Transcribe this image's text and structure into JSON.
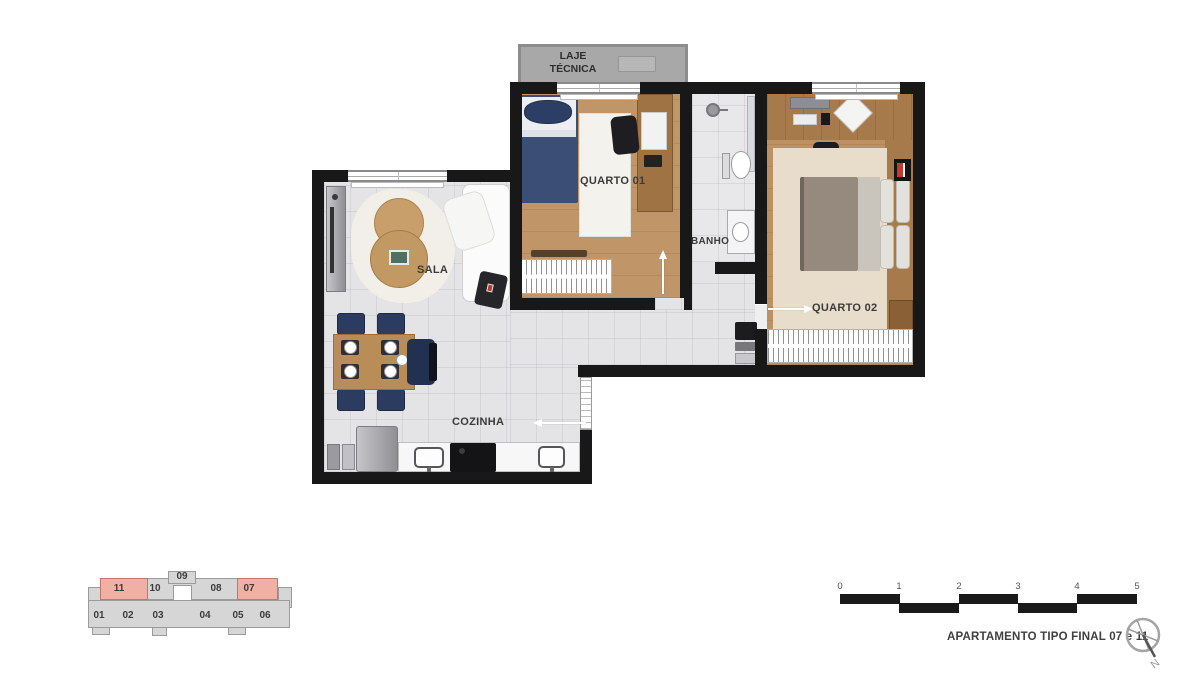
{
  "plan": {
    "labels": {
      "laje_line1": "LAJE",
      "laje_line2": "TÉCNICA",
      "quarto01": "QUARTO 01",
      "banho": "BANHO",
      "quarto02": "QUARTO 02",
      "sala": "SALA",
      "cozinha": "COZINHA"
    },
    "colors": {
      "wall": "#181818",
      "wood_floor": "#c09668",
      "tile_floor": "#e4e4e7",
      "laje_gray": "#a8a8a8",
      "bed_blue": "#3b4e76",
      "bed_taupe": "#958a7d",
      "chair_navy": "#2c3b60",
      "keyplan_gray": "#d6d6d6",
      "keyplan_highlight": "#f0b1a4"
    }
  },
  "keyplan": {
    "top_units": [
      {
        "label": "11",
        "highlighted": true
      },
      {
        "label": "10",
        "highlighted": false
      },
      {
        "label": "09",
        "highlighted": false
      },
      {
        "label": "08",
        "highlighted": false
      },
      {
        "label": "07",
        "highlighted": true
      }
    ],
    "bottom_units": [
      {
        "label": "01"
      },
      {
        "label": "02"
      },
      {
        "label": "03"
      },
      {
        "label": "04"
      },
      {
        "label": "05"
      },
      {
        "label": "06"
      }
    ]
  },
  "scalebar": {
    "ticks": [
      "0",
      "1",
      "2",
      "3",
      "4",
      "5"
    ]
  },
  "footer": {
    "caption": "APARTAMENTO TIPO FINAL 07 e 11",
    "compass_north": "N"
  }
}
